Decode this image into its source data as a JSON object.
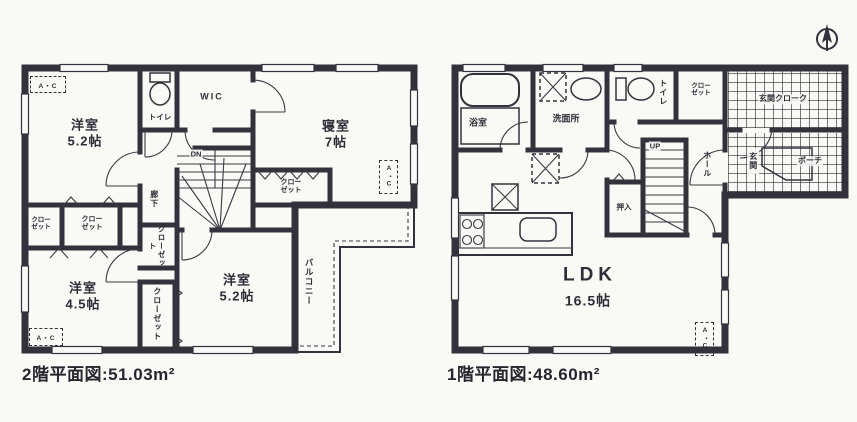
{
  "colors": {
    "ink": "#32323c",
    "paper": "#f9f9f6"
  },
  "shared": {
    "closet": "クローゼット",
    "closet_line1": "クロー",
    "closet_line2": "ゼット",
    "ac": "A・C"
  },
  "floor2": {
    "caption": "2階平面図:51.03m²",
    "room_a_name": "洋室",
    "room_a_size": "5.2帖",
    "toilet": "トイレ",
    "wic": "WIC",
    "bedroom_name": "寝室",
    "bedroom_size": "7帖",
    "hallway": "廊下",
    "dn": "DN",
    "room_b_name": "洋室",
    "room_b_size": "4.5帖",
    "room_c_name": "洋室",
    "room_c_size": "5.2帖",
    "balcony": "バルコニー"
  },
  "floor1": {
    "caption": "1階平面図:48.60m²",
    "bath": "浴室",
    "washroom": "洗面所",
    "toilet": "トイレ",
    "closet_line1": "クロー",
    "closet_line2": "ゼット",
    "cloak": "玄関クローク",
    "hall": "ホール",
    "genkan": "玄関",
    "porch": "ポーチ",
    "oshiire": "押入",
    "up": "UP",
    "ldk_name": "LDK",
    "ldk_size": "16.5帖"
  }
}
